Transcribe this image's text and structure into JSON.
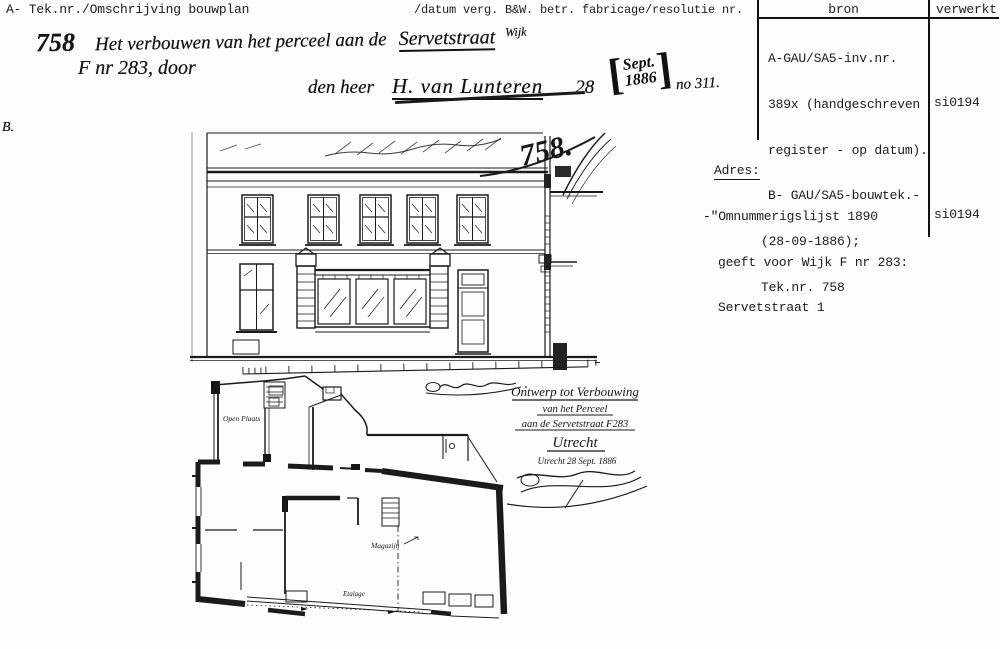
{
  "header": {
    "left": "A- Tek.nr./Omschrijving bouwplan",
    "right": "/datum verg. B&W. betr. fabricage/resolutie nr.",
    "margin_note": "B."
  },
  "entry": {
    "number": "758",
    "description": "Het verbouwen van het perceel aan de",
    "street": "Servetstraat",
    "wijk": "Wijk",
    "parcel": "F nr 283, door",
    "applicant_prefix": "den heer",
    "applicant_name": "H. van Lunteren",
    "date_day": "28",
    "stamp_month": "Sept.",
    "stamp_year": "1886",
    "resolution_nr": "no 311."
  },
  "bron_table": {
    "col_bron": "bron",
    "col_verwerkt": "verwerkt",
    "bron_lines": [
      "A-GAU/SA5-inv.nr.",
      "389x (handgeschreven",
      "register - op datum).",
      "B- GAU/SA5-bouwtek.-",
      "(28-09-1886);",
      "Tek.nr. 758"
    ],
    "verwerkt": "si0194"
  },
  "adres": {
    "label": "Adres:",
    "lines": [
      "-\"Omnummerigslijst 1890",
      "geeft voor Wijk F nr 283:",
      "Servetstraat 1"
    ],
    "verwerkt": "si0194"
  },
  "drawing": {
    "sheet_number": "758.",
    "title_line1": "Ontwerp tot Verbouwing",
    "title_line2": "van het Perceel",
    "title_line3": "aan de Servetstraat F283",
    "title_line4": "Utrecht",
    "title_date": "Utrecht 28 Sept. 1886",
    "label_open_plaats": "Open Plaats",
    "label_magazijn": "Magazijn",
    "label_etalage": "Etalage"
  }
}
